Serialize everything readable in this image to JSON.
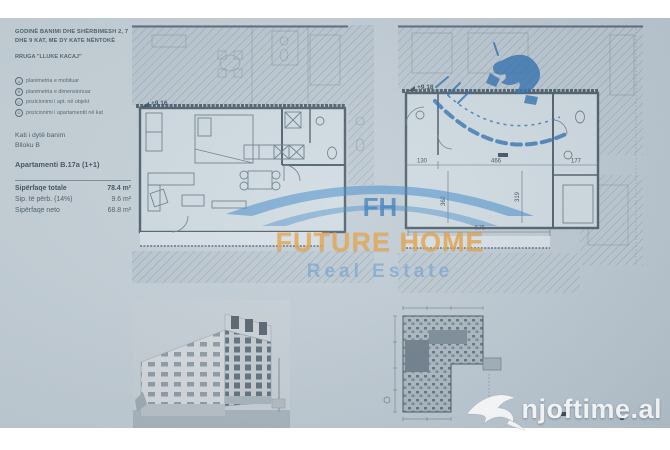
{
  "document": {
    "header_line1": "GODINË BANIMI DHE SHËRBIMESH 2, 7",
    "header_line2": "DHE 9 KAT, ME DY KATE NËNTOKË",
    "street": "RRUGA \"LLUKE KACAJ\"",
    "legend": [
      {
        "key": "A",
        "label": "planimetria e mobiluar"
      },
      {
        "key": "B",
        "label": "planimetria e dimensionuar"
      },
      {
        "key": "C",
        "label": "pozicionimi i apt. në objekt"
      },
      {
        "key": "D",
        "label": "pozicionimi i apartamentit në kat"
      }
    ],
    "floor": "Kati i dytë banim",
    "block": "Blloku B",
    "apartment": "Apartamenti B.17a (1+1)",
    "areas": [
      {
        "label": "Sipërfaqe totale",
        "value": "78.4 m²"
      },
      {
        "label": "Sip. të përb. (14%)",
        "value": "9.6 m²"
      },
      {
        "label": "Sipërfaqe neto",
        "value": "68.8 m²"
      }
    ]
  },
  "plans": {
    "furnished_level": "+9.16",
    "dimensioned_level": "+9.18",
    "dims": {
      "hall_w": "130",
      "room_w": "466",
      "bath_w": "177",
      "bottom_w": "575",
      "room_h": "362",
      "room_h2": "319"
    }
  },
  "watermark": {
    "initials": "FH",
    "title": "FUTURE HOME",
    "subtitle": "Real Estate"
  },
  "branding": {
    "site": "njoftime.al"
  },
  "colors": {
    "paper": "#c4cfd7",
    "wall": "#4d5e6b",
    "stamp_blue": "#2d6fb0",
    "watermark_orange": "#e9a03c",
    "watermark_blue": "#4a8cc8"
  }
}
